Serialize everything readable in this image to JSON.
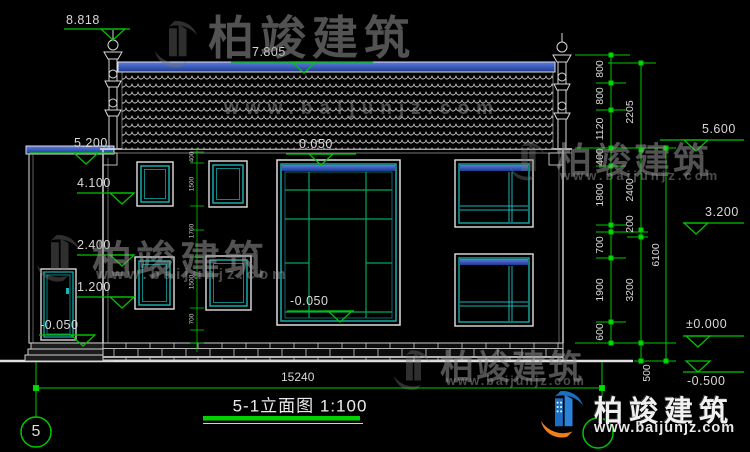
{
  "drawing": {
    "title": "5-1立面图 1:100",
    "grid_bubble_left": "5",
    "bottom_width_dim": "15240",
    "markers": {
      "top_finial": "8.818",
      "ridge": "7.805",
      "wing_top": "5.200",
      "upper_window_top": "4.100",
      "upper_window_sill": "2.400",
      "lower_window_top": "1.200",
      "wing_ground": "-0.050",
      "entry_top": "0.050",
      "entry_bottom": "-0.050",
      "eave_right": "5.600",
      "floor2_right": "3.200",
      "ground_right": "±0.000",
      "site_right": "-0.500"
    },
    "dim_chain_outer": [
      "800",
      "800",
      "1120",
      "400",
      "1800",
      "700",
      "1900",
      "600"
    ],
    "dim_chain_mid": [
      "2205",
      "2400",
      "200",
      "3200",
      "500"
    ],
    "dim_total": "6100",
    "dim_inner": [
      "400",
      "1500",
      "1700",
      "1500",
      "700"
    ]
  },
  "watermark": {
    "brand": "柏竣建筑",
    "url": "www.baijunjz.com"
  },
  "colors": {
    "dimension_green": "#00c800",
    "frame_cyan": "#19b6b6",
    "band_blue": "#2e54b4",
    "logo_blue": "#1a6fc4",
    "logo_orange": "#f08019"
  }
}
